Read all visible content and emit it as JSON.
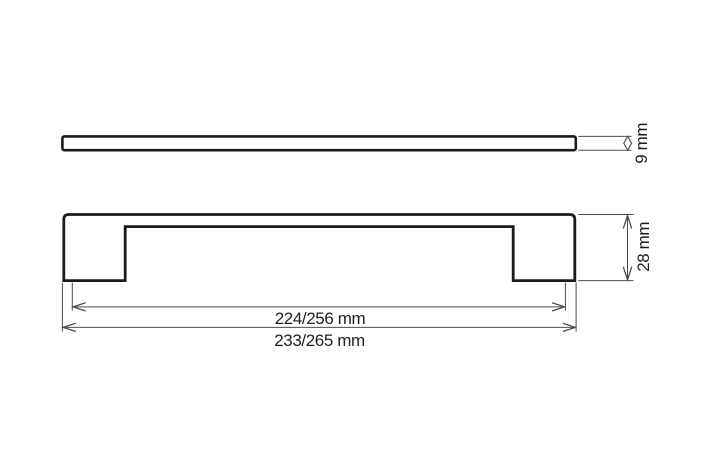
{
  "drawing": {
    "type": "technical-dimension-drawing",
    "subject": "cabinet handle",
    "views": {
      "top": {
        "thickness_label": "9 mm"
      },
      "front": {
        "height_label": "28 mm",
        "hole_spacing_label": "224/256 mm",
        "overall_length_label": "233/265 mm"
      }
    }
  },
  "colors": {
    "background": "#ffffff",
    "outline": "#1b1b1b",
    "dimension_line": "#4d4d4d",
    "text": "#1f1f1f"
  }
}
